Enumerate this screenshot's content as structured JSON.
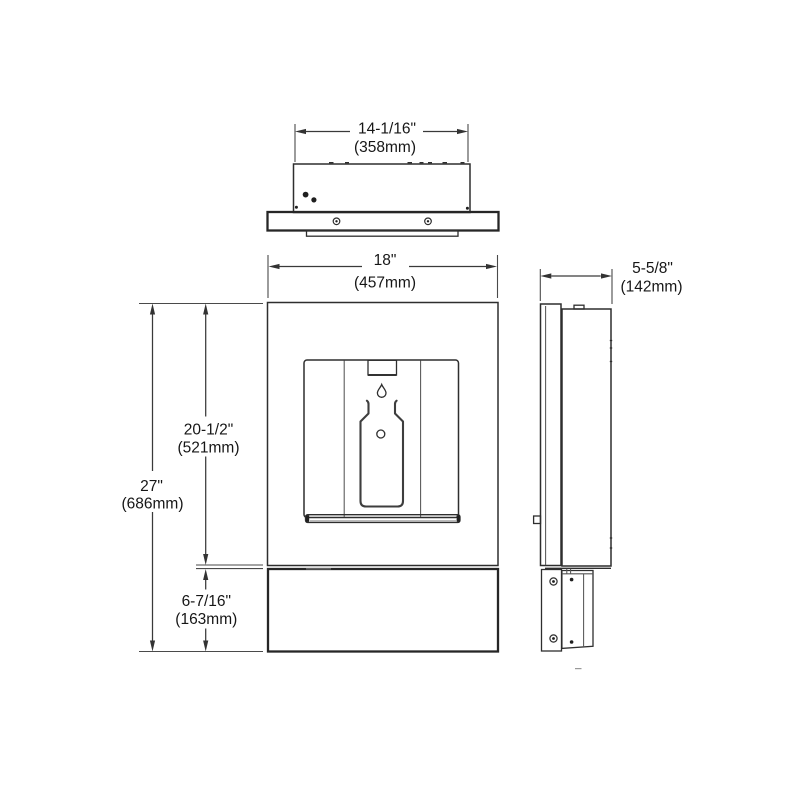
{
  "page": {
    "background": "#ffffff"
  },
  "colors": {
    "line": "#2e2e2e",
    "dim_line": "#3a3a3a",
    "text": "#161616"
  },
  "icons": {
    "droplet": "water-drop-icon",
    "bottle": "bottle-outline-icon"
  },
  "dimensions": {
    "top_width": {
      "in": "14-1/16\"",
      "mm": "(358mm)"
    },
    "front_width": {
      "in": "18\"",
      "mm": "(457mm)"
    },
    "overall_height": {
      "in": "27\"",
      "mm": "(686mm)"
    },
    "upper_height": {
      "in": "20-1/2\"",
      "mm": "(521mm)"
    },
    "apron_height": {
      "in": "6-7/16\"",
      "mm": "(163mm)"
    },
    "depth": {
      "in": "5-5/8\"",
      "mm": "(142mm)"
    }
  }
}
